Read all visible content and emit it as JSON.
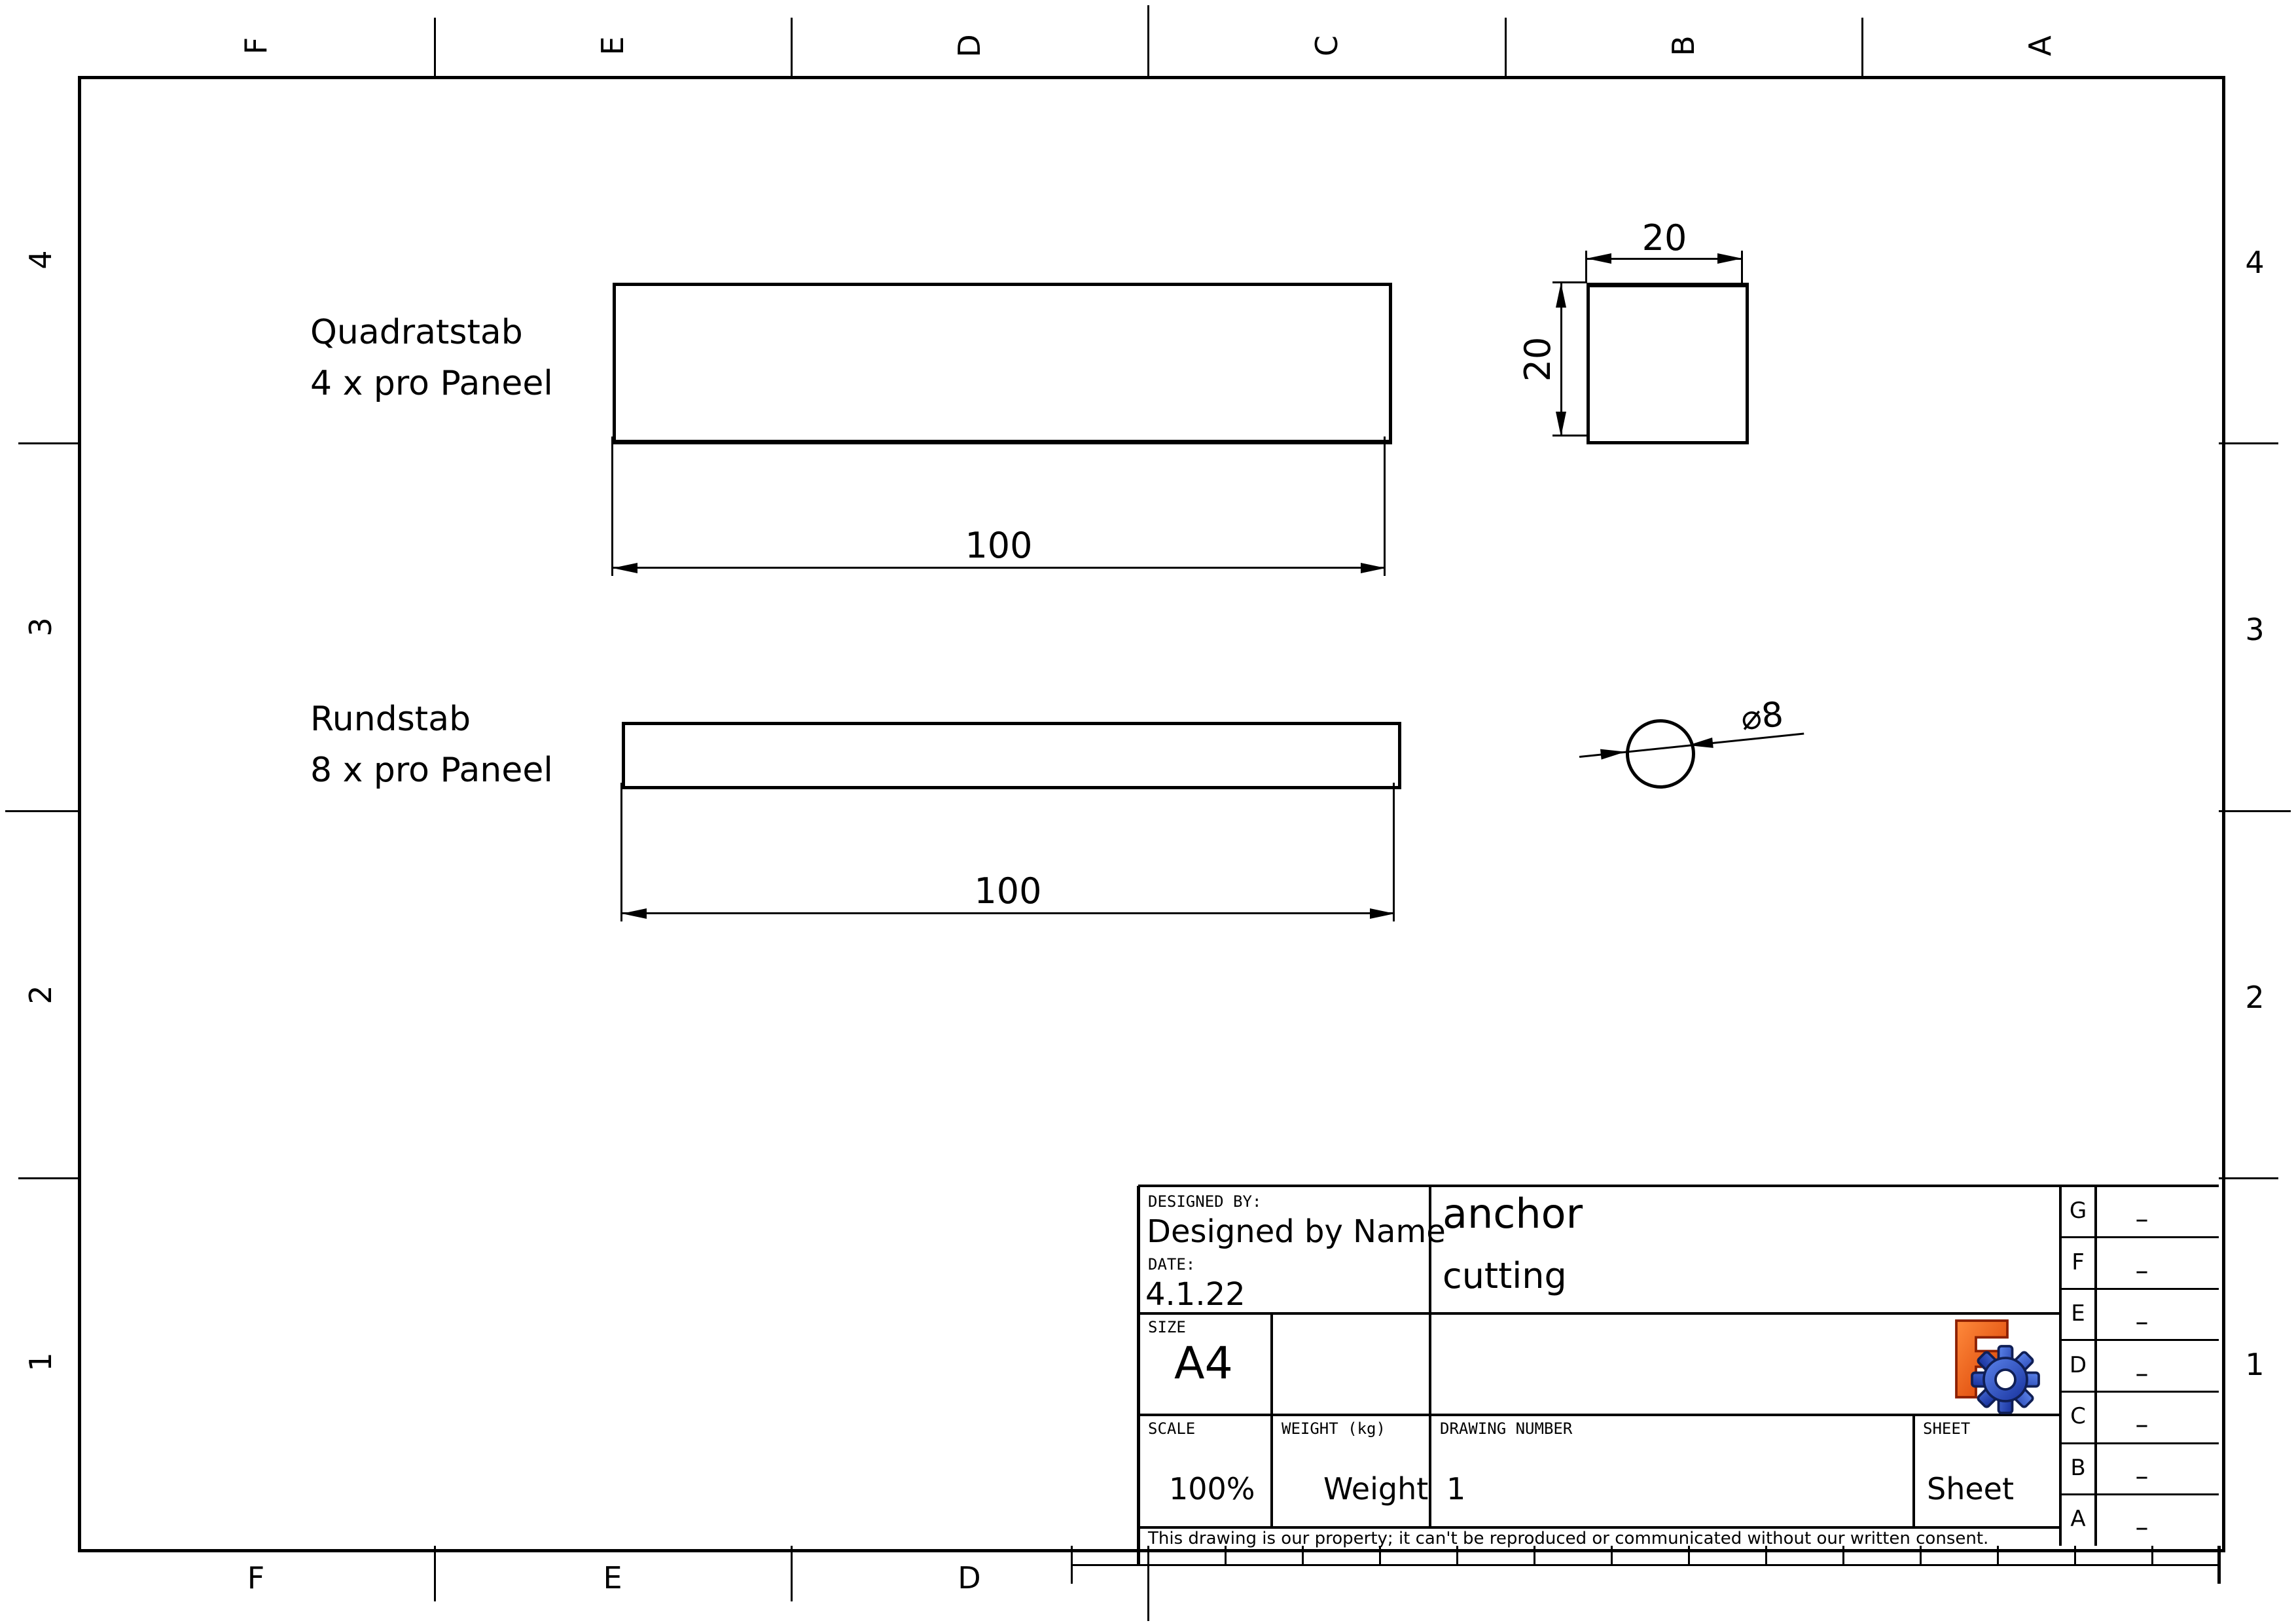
{
  "page": {
    "background": "#ffffff",
    "line_color": "#000000"
  },
  "border": {
    "top_letters": [
      "F",
      "E",
      "D",
      "C",
      "B",
      "A"
    ],
    "bottom_letters": [
      "F",
      "E",
      "D"
    ],
    "left_numbers": [
      "4",
      "3",
      "2",
      "1"
    ],
    "right_numbers": [
      "4",
      "3",
      "2",
      "1"
    ]
  },
  "drawing": {
    "parts": [
      {
        "label_line1": "Quadratstab",
        "label_line2": "4 x pro Paneel",
        "length_dim": "100"
      },
      {
        "label_line1": "Rundstab",
        "label_line2": "8 x pro Paneel",
        "length_dim": "100"
      }
    ],
    "square_detail": {
      "width_dim": "20",
      "height_dim": "20"
    },
    "circle_detail": {
      "diameter_dim": "⌀8"
    }
  },
  "title_block": {
    "designed_by_label": "DESIGNED BY:",
    "designed_by_value": "Designed by Name",
    "date_label": "DATE:",
    "date_value": "4.1.22",
    "title_line1": "anchor",
    "title_line2": "cutting",
    "size_label": "SIZE",
    "size_value": "A4",
    "scale_label": "SCALE",
    "scale_value": "100%",
    "weight_label": "WEIGHT (kg)",
    "weight_value": "Weight",
    "drawing_number_label": "DRAWING NUMBER",
    "drawing_number_value": "1",
    "sheet_label": "SHEET",
    "sheet_value": "Sheet",
    "disclaimer": "This drawing is our property; it can't be reproduced or communicated without our written consent.",
    "revision_rows": [
      {
        "letter": "G",
        "value": "–"
      },
      {
        "letter": "F",
        "value": "–"
      },
      {
        "letter": "E",
        "value": "–"
      },
      {
        "letter": "D",
        "value": "–"
      },
      {
        "letter": "C",
        "value": "–"
      },
      {
        "letter": "B",
        "value": "–"
      },
      {
        "letter": "A",
        "value": "–"
      }
    ]
  },
  "logo": {
    "letter": "F",
    "orange_light": "#ff8a3c",
    "orange_dark": "#d63c00",
    "orange_stroke": "#8c1f00",
    "blue_light": "#5b83ea",
    "blue_dark": "#16309c",
    "blue_stroke": "#101f55",
    "hole": "#ffffff"
  }
}
